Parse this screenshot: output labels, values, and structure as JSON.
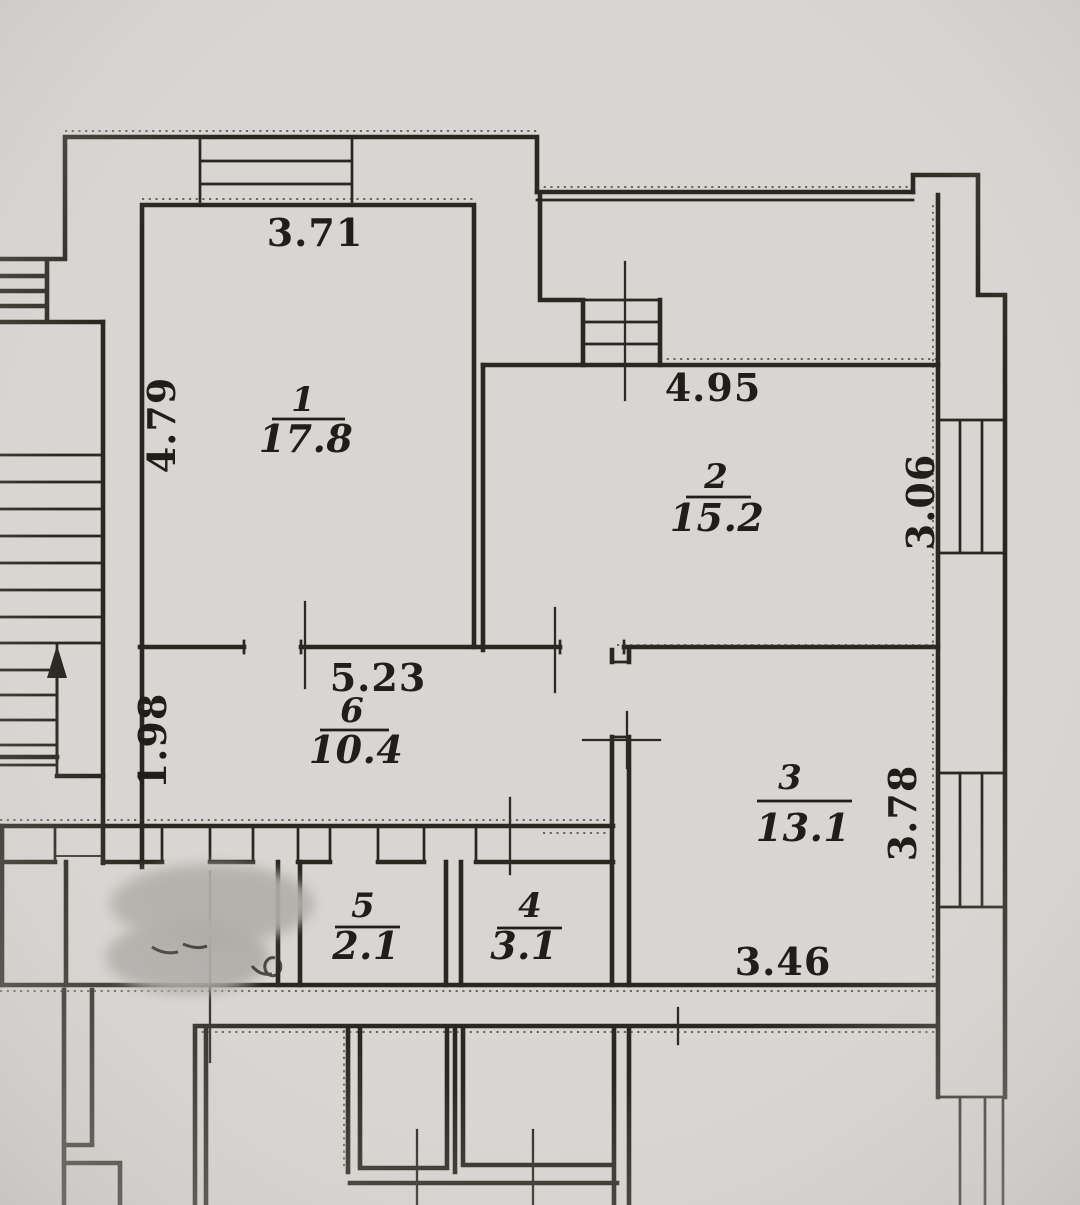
{
  "plan": {
    "type": "apartment-floor-plan-scan",
    "rooms": [
      {
        "number": "1",
        "area": "17.8"
      },
      {
        "number": "2",
        "area": "15.2"
      },
      {
        "number": "3",
        "area": "13.1"
      },
      {
        "number": "4",
        "area": "3.1"
      },
      {
        "number": "5",
        "area": "2.1"
      },
      {
        "number": "6",
        "area": "10.4"
      }
    ],
    "dimensions": {
      "room1_width_top": "3.71",
      "room1_depth_left": "4.79",
      "room2_width_top": "4.95",
      "room2_depth_right": "3.06",
      "hall_width_top": "5.23",
      "hall_depth_left": "1.98",
      "room3_depth_right": "3.78",
      "room3_width_bottom": "3.46"
    },
    "icons": {
      "stairs_arrow": "stairs-up-arrow"
    },
    "colors": {
      "paper": "#d8d6d2",
      "ink": "#29271f",
      "redaction": "#b3b0ac"
    }
  }
}
